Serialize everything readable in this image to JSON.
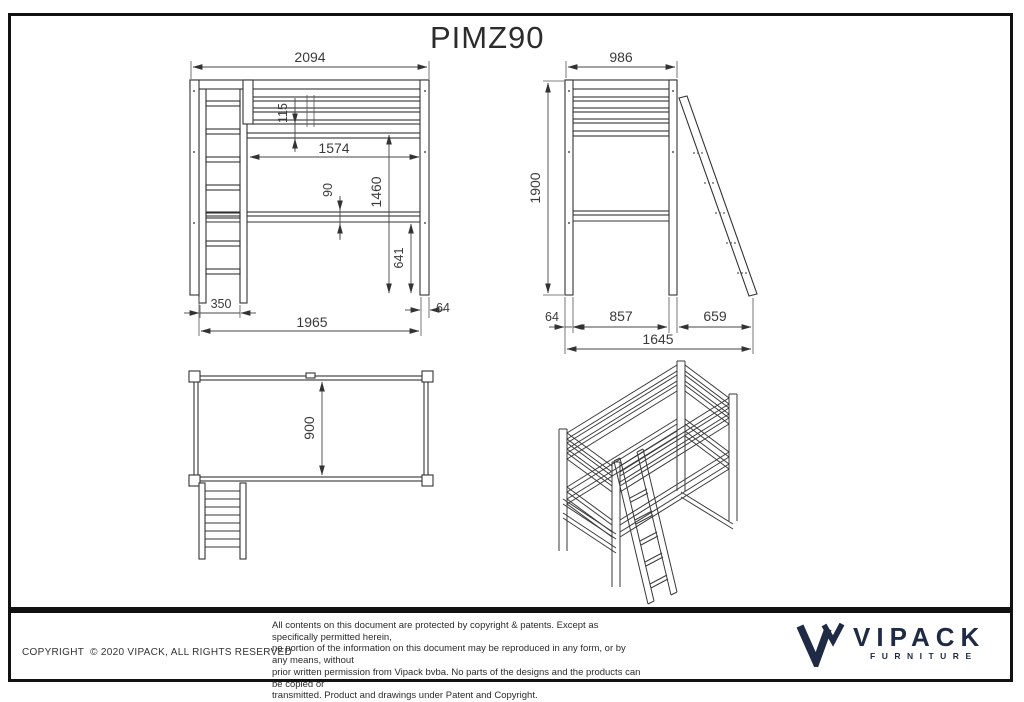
{
  "title": "PIMZ90",
  "dims": {
    "front": {
      "overall_width": "2094",
      "guard_rail_height": "115",
      "inner_length": "1574",
      "clearance_height": "1460",
      "deck_thickness": "90",
      "leg_clearance": "641",
      "ladder_width": "350",
      "footprint_width": "1965",
      "post_width": "64"
    },
    "side": {
      "overall_depth": "986",
      "overall_height": "1900",
      "post_width": "64",
      "inner_depth": "857",
      "ladder_reach": "659",
      "total_depth": "1645"
    },
    "plan": {
      "bed_depth": "900"
    }
  },
  "footer": {
    "copyright": "COPYRIGHT  © 2020 VIPACK, ALL RIGHTS RESERVED",
    "legal_lines": [
      "All contents on this document are protected by copyright & patents. Except as specifically permitted herein,",
      "no portion of the information on this document may be reproduced in any form, or by any means, without",
      "prior written permission from Vipack bvba. No parts of the designs and the products can be copied or",
      "transmitted. Product and drawings under Patent and Copyright."
    ],
    "logo_brand": "VIPACK",
    "logo_sub": "FURNITURE"
  },
  "colors": {
    "line": "#333333",
    "dimension_text": "#3a3a3a",
    "border": "#111111",
    "logo_navy": "#1f2a44"
  }
}
